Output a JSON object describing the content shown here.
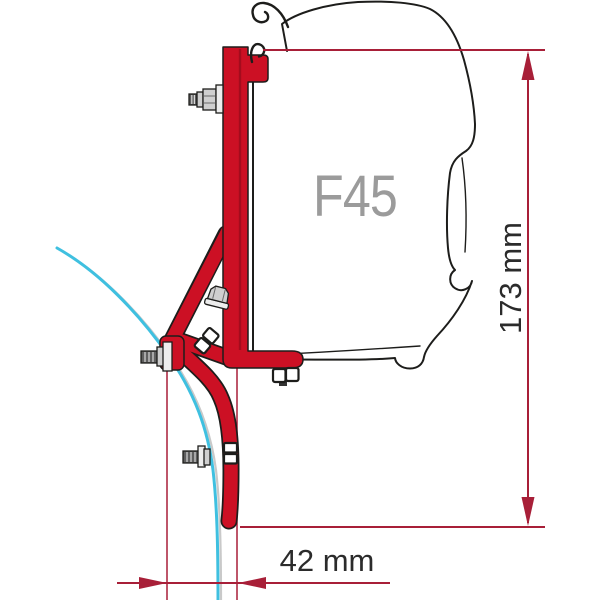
{
  "labels": {
    "product": "F45",
    "height_dimension": "173 mm",
    "width_dimension": "42 mm"
  },
  "colors": {
    "background": "#ffffff",
    "bracket_red": "#cc1024",
    "dimension_red": "#a81f38",
    "outline_dark": "#1d1d1b",
    "wall_cyan": "#3fc0e0",
    "wall_grey": "#c9c9c9",
    "label_grey": "#9b9b9b",
    "dimension_text": "#2b2b2b"
  }
}
